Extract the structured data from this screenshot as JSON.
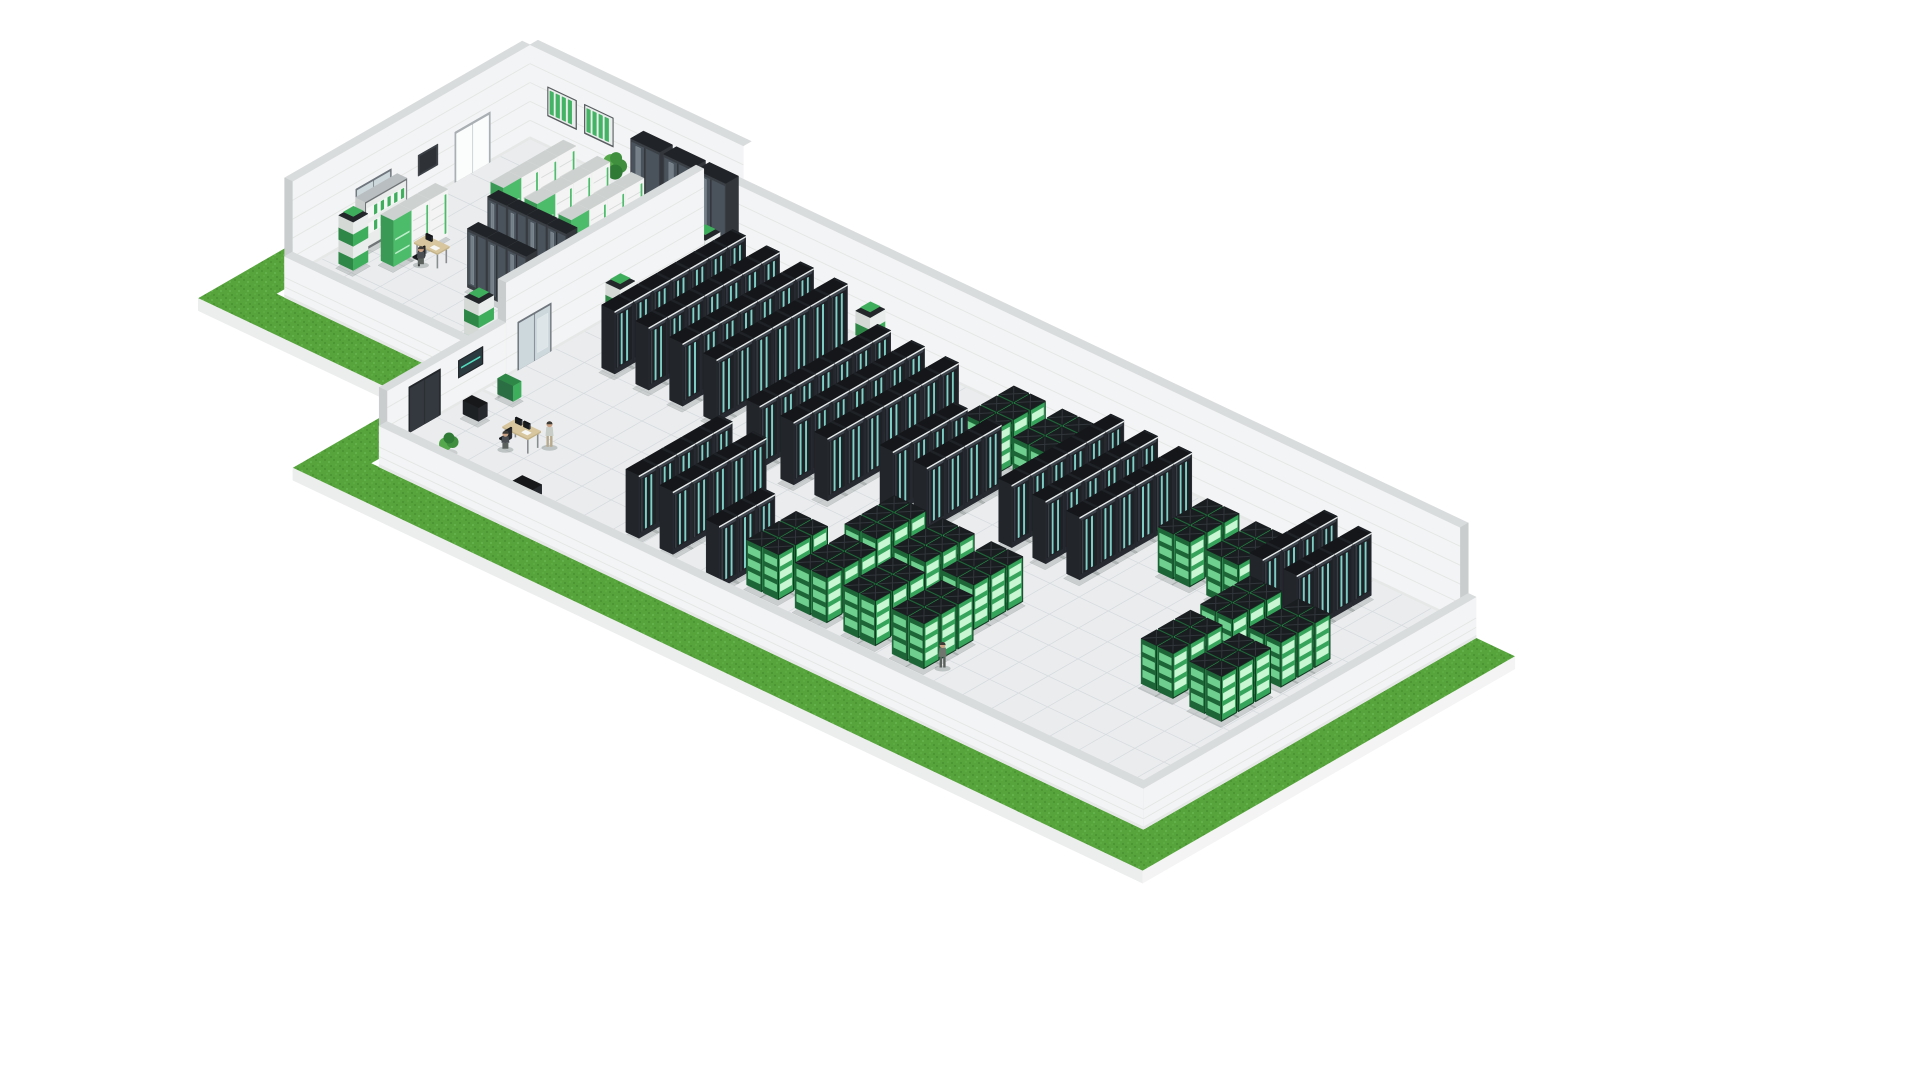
{
  "title": "Isometric 3D illustration of a green data center: office annex with UPS cabinets and a large server hall with dark server racks and green battery cabinets, surrounded by grass",
  "projection": {
    "ox": 530,
    "oy": 156,
    "ux": 9.7,
    "uxY": 9.9,
    "uyX": 4.6,
    "uyY": 5.7,
    "uz": 10.5,
    "floor_z": 1.6
  },
  "palette": {
    "background": "#ffffff",
    "grass_base": "#57a43d",
    "grass_dark": "#4c9634",
    "grass_light": "#62b14a",
    "grass_mid": "#5cab42",
    "slab_front": "#eceeed",
    "slab_side": "#f3f4f3",
    "wall_face": "#f3f4f5",
    "wall_cap": "#d9dcdd",
    "wall_end": "#c9cdce",
    "wall_line": "#e4e6e5",
    "wall_base": "#e6e8e8",
    "floor": "#eaecee",
    "floor_grid": "rgba(165,172,180,0.28)",
    "walkway_base": "#2f3337",
    "walkway_green": "#45bd66",
    "rack_top": "#141619",
    "rack_front": "#272b31",
    "rack_panel": "#1e2227",
    "rack_stripe": "#7fd2c8",
    "rack_side": "#22252a",
    "rack_rim": "#e6eaea",
    "rack_seam": "#3a4149",
    "rack_vent": "#3d434b",
    "green_top": "#1a1d20",
    "green_frame": "#123b22",
    "green_front": "#37a45c",
    "green_bar": "#c9f6d3",
    "green_side": "#1d6537",
    "green_side_bar": "#6fcf8e",
    "green_ridge": "#30363b",
    "ups_front": "#f3f4f3",
    "ups_side": "#dfe2e1",
    "ups_top": "#cdd1d0",
    "ups_seam": "#d8dbda",
    "ups_green": "#4cbb6a",
    "ups_green_side": "#3a9a55",
    "ups_green_bar": "#bdeecb",
    "glass_front": "#3a3f45",
    "glass_pane": "#4a535b",
    "glass_hi": "rgba(215,230,238,0.30)",
    "glass_top": "#202327",
    "glass_side": "#33373c",
    "glass_frame": "#2c3034",
    "pillar_green": "#3fae5c",
    "pillar_green_side": "#2f8747",
    "pillar_white": "#e9edeb",
    "pillar_white_side": "#d4d9d6",
    "pillar_cap": "#23272a",
    "door_frame": "#a9afb2",
    "door_panel": "#fbfcfc",
    "glassdoor_frame": "#6e757c",
    "glassdoor_pane": "#ccd8dc",
    "dark_panel": "#3c4147",
    "dark_panel_inner": "#2e3237",
    "darkdoor": "#34393f",
    "darkdoor_frame": "#23262a",
    "cab_frame": "#585c5f",
    "cab_body": "#e9edeb",
    "cab_slat": "#43b364",
    "screen_frame": "#202428",
    "screen_face": "#2b3a3f",
    "screen_glow": "#53e0c0",
    "shelf_frame": "#707476",
    "shelf_body": "#e9eceb",
    "shelf_green": "#3fae5c",
    "shelf_side": "#c8cccb",
    "desk_top": "#d8c79e",
    "desk_edge": "#c4b287",
    "desk_leg": "#898d90",
    "chair": "#2c2f33",
    "monitor": "#23262a",
    "skin": "#caa183",
    "hair": "#3d3a35",
    "suit": "#3b3f46",
    "worker": "#7e857f",
    "worker2": "#6f766e",
    "light_shirt": "#c9cdc7",
    "khaki": "#b7a98c",
    "plant_green1": "#3f8f3f",
    "plant_green2": "#55a84b",
    "plant_green3": "#2f7a35",
    "pot": "#d8d8d6",
    "pot_dark": "#3c3f41",
    "shadow": "rgba(60,70,68,0.18)",
    "person_shadow": "rgba(60,70,68,0.25)",
    "box_dark": "#26292d",
    "box_dark_top": "#16181a"
  },
  "grass": {
    "polygon": [
      [
        -4.8,
        0
      ],
      [
        -4.8,
        28.8
      ],
      [
        17.2,
        28.8
      ],
      [
        17.2,
        40.8
      ],
      [
        104.8,
        40.8
      ],
      [
        104.8,
        3.2
      ],
      [
        100.8,
        3.2
      ],
      [
        100.8,
        36.8
      ],
      [
        21.2,
        36.8
      ],
      [
        21.2,
        24.8
      ],
      [
        -0.8,
        24.8
      ],
      [
        -0.8,
        0
      ]
    ],
    "slab_depth": 1.2,
    "slab_edges": [
      [
        [
          -4.8,
          28.8
        ],
        [
          17.2,
          28.8
        ]
      ],
      [
        [
          17.2,
          40.8
        ],
        [
          104.8,
          40.8
        ]
      ],
      [
        [
          104.8,
          40.8
        ],
        [
          104.8,
          3.2
        ]
      ]
    ]
  },
  "floors": [
    {
      "name": "annex-floor",
      "x0": 0,
      "y0": 0,
      "x1": 22,
      "y1": 24
    },
    {
      "name": "hall-floor",
      "x0": 22,
      "y0": 4,
      "x1": 100,
      "y1": 36
    }
  ],
  "walkway": {
    "x0": 1.2,
    "y0": 22.2,
    "x1": 20.5,
    "y1": 23.5,
    "dashes": 9
  },
  "walls": [
    {
      "name": "annex-west-wall",
      "plane": "x",
      "at": 0,
      "from": 0,
      "to": 24,
      "h": 9,
      "thick": 0.8,
      "depth": -930,
      "endCap": 24,
      "texture": "brick",
      "items": [
        {
          "type": "double_door_white",
          "a0": 4,
          "a1": 7.6,
          "z1": 6.4
        },
        {
          "type": "dark_panel",
          "a0": 9.3,
          "a1": 11.3,
          "z0": 4.2,
          "z1": 6.2
        },
        {
          "type": "double_door_glass",
          "a0": 14,
          "a1": 17.6,
          "z1": 6.4
        }
      ]
    },
    {
      "name": "annex-north-wall",
      "plane": "y",
      "at": 0,
      "from": 0,
      "to": 22,
      "h": 9,
      "thick": 0.8,
      "depth": -925,
      "items": [
        {
          "type": "green_wall_cabinet",
          "a0": 1.8,
          "a1": 4.8,
          "z0": 4.6,
          "z1": 7.4
        },
        {
          "type": "green_wall_cabinet",
          "a0": 5.6,
          "a1": 8.6,
          "z0": 4.6,
          "z1": 7.4
        }
      ]
    },
    {
      "name": "hall-north-wall",
      "plane": "y",
      "at": 4,
      "from": 22,
      "to": 100,
      "h": 9,
      "thick": 0.8,
      "depth": -920,
      "endCap": 100,
      "items": []
    },
    {
      "name": "separating-wall",
      "plane": "x",
      "at": 22,
      "from": 4,
      "to": 24,
      "h": 9,
      "thick": 0.8,
      "depth": 33,
      "endCap": 24,
      "items": [
        {
          "type": "double_door_glass",
          "a0": 19.4,
          "a1": 22.8,
          "z1": 6.2
        }
      ]
    },
    {
      "name": "hall-west-wall",
      "plane": "x",
      "at": 22,
      "from": 24,
      "to": 36,
      "h": 5.2,
      "thick": 0.8,
      "depth": 46.5,
      "endCap": 36,
      "items": [
        {
          "type": "wall_screen",
          "a0": 26.3,
          "a1": 28.8,
          "z0": 4.1,
          "z1": 5.8
        },
        {
          "type": "dark_double_door",
          "a0": 30.6,
          "a1": 33.8,
          "z1": 6.0
        }
      ]
    },
    {
      "name": "annex-south-parapet",
      "plane": "y",
      "at": 24,
      "from": 0,
      "to": 22,
      "h": 2.3,
      "thick": 0.8,
      "low": true,
      "outward": true,
      "depth": 46,
      "endCap": 22,
      "texture": "brick",
      "items": []
    },
    {
      "name": "hall-south-parapet",
      "plane": "y",
      "at": 36,
      "from": 22,
      "to": 100.8,
      "h": 2.3,
      "thick": 0.8,
      "low": true,
      "outward": true,
      "depth": 985,
      "endCap": 100.8,
      "texture": "brick",
      "items": []
    },
    {
      "name": "hall-east-parapet",
      "plane": "x",
      "at": 100,
      "from": 3.2,
      "to": 36.8,
      "h": 2.3,
      "thick": 0.8,
      "low": true,
      "outward": true,
      "depth": 990,
      "items": []
    }
  ],
  "dark_rack_rows": [
    {
      "x": 26.5,
      "y": 5.5,
      "n": 7
    },
    {
      "x": 30,
      "y": 5.5,
      "n": 7
    },
    {
      "x": 33.5,
      "y": 5.5,
      "n": 7
    },
    {
      "x": 37,
      "y": 5.5,
      "n": 7
    },
    {
      "x": 44,
      "y": 8,
      "n": 7
    },
    {
      "x": 47.5,
      "y": 8,
      "n": 7
    },
    {
      "x": 51,
      "y": 8,
      "n": 7
    },
    {
      "x": 44,
      "y": 24,
      "n": 5
    },
    {
      "x": 47.5,
      "y": 24,
      "n": 5
    },
    {
      "x": 56,
      "y": 12,
      "n": 4
    },
    {
      "x": 59.5,
      "y": 12,
      "n": 4
    },
    {
      "x": 66,
      "y": 6,
      "n": 6
    },
    {
      "x": 69.5,
      "y": 6,
      "n": 6
    },
    {
      "x": 73,
      "y": 6,
      "n": 6
    },
    {
      "x": 87.5,
      "y": 5.5,
      "n": 4
    },
    {
      "x": 91,
      "y": 5.5,
      "n": 4
    },
    {
      "x": 53.5,
      "y": 29,
      "n": 3
    }
  ],
  "green_clusters": [
    {
      "x": 56,
      "y": 6
    },
    {
      "x": 61,
      "y": 6
    },
    {
      "x": 78,
      "y": 8
    },
    {
      "x": 83,
      "y": 8
    },
    {
      "x": 88,
      "y": 13.5
    },
    {
      "x": 93,
      "y": 13.5
    },
    {
      "x": 88,
      "y": 19.5
    },
    {
      "x": 93,
      "y": 19.5
    },
    {
      "x": 60,
      "y": 22
    },
    {
      "x": 65,
      "y": 22
    },
    {
      "x": 70,
      "y": 22
    },
    {
      "x": 56,
      "y": 28
    },
    {
      "x": 61,
      "y": 28
    },
    {
      "x": 66,
      "y": 28
    },
    {
      "x": 71,
      "y": 28
    }
  ],
  "ups_rows": [
    {
      "x": 6.5,
      "y": 3,
      "n": 4
    },
    {
      "x": 10,
      "y": 3,
      "n": 4
    },
    {
      "x": 13.5,
      "y": 3,
      "n": 4
    },
    {
      "x": 3.5,
      "y": 13,
      "n": 3
    }
  ],
  "glass_rows": [
    {
      "x": 9,
      "y": 12,
      "n": 4
    },
    {
      "x": 11,
      "y": 16,
      "n": 3
    }
  ],
  "wardrobes": [
    {
      "x": 12,
      "y": 0.3
    },
    {
      "x": 15.4,
      "y": 0.3
    },
    {
      "x": 18.8,
      "y": 0.3
    }
  ],
  "shelf": {
    "x": 0.6,
    "y": 14,
    "w": 1.0,
    "d": 4.2,
    "h": 4.6
  },
  "pillars": [
    {
      "x": 23.1,
      "y": 4.9
    },
    {
      "x": 23.1,
      "y": 13.5
    },
    {
      "x": 16.5,
      "y": 21.3
    },
    {
      "x": 1.4,
      "y": 19.2
    },
    {
      "x": 40,
      "y": 4.8
    }
  ],
  "desks": [
    {
      "name": "annex-office-desk",
      "x": 5.2,
      "y": 15.6,
      "w": 2.4,
      "d": 1.2,
      "monitors": 1,
      "chair": {
        "x": 6.2,
        "y": 17.3
      }
    },
    {
      "name": "hall-control-desk",
      "x": 28.3,
      "y": 29.2,
      "w": 2.6,
      "d": 1.3,
      "monitors": 2,
      "chair": {
        "x": 28.9,
        "y": 30.8
      }
    }
  ],
  "people": [
    {
      "name": "businessman-walking",
      "x": 15.5,
      "y": 9.5,
      "variant": "suit",
      "briefcase": true
    },
    {
      "name": "technician-walking-hall",
      "x": 24.3,
      "y": 9,
      "variant": "worker"
    },
    {
      "name": "technician-walking-bottom",
      "x": 75.2,
      "y": 32,
      "variant": "worker2"
    },
    {
      "name": "operator-standing",
      "x": 31.3,
      "y": 28.7,
      "variant": "light"
    },
    {
      "name": "operator-sitting",
      "x": 29.0,
      "y": 30.9,
      "variant": "sitting"
    },
    {
      "name": "office-worker-sitting",
      "x": 6.1,
      "y": 17.0,
      "variant": "sitting"
    }
  ],
  "plants": [
    {
      "name": "potted-plant-annex",
      "x": 10.2,
      "y": 1.4,
      "type": "tall"
    },
    {
      "name": "potted-plant-hall-corner",
      "x": 26.3,
      "y": 34.0,
      "type": "bush"
    }
  ],
  "misc_boxes": [
    {
      "name": "storage-box",
      "x": 33.5,
      "y": 33.6,
      "w": 2.0,
      "d": 1.1,
      "h": 0.9,
      "type": "blackbox"
    },
    {
      "name": "sideboard-cabinet",
      "x": 23.2,
      "y": 28.6,
      "w": 1.6,
      "d": 0.9,
      "h": 1.3,
      "type": "blackbox"
    },
    {
      "name": "green-console-table",
      "x": 23.2,
      "y": 25.2,
      "w": 1.6,
      "d": 0.8,
      "h": 1.5,
      "type": "console"
    }
  ]
}
